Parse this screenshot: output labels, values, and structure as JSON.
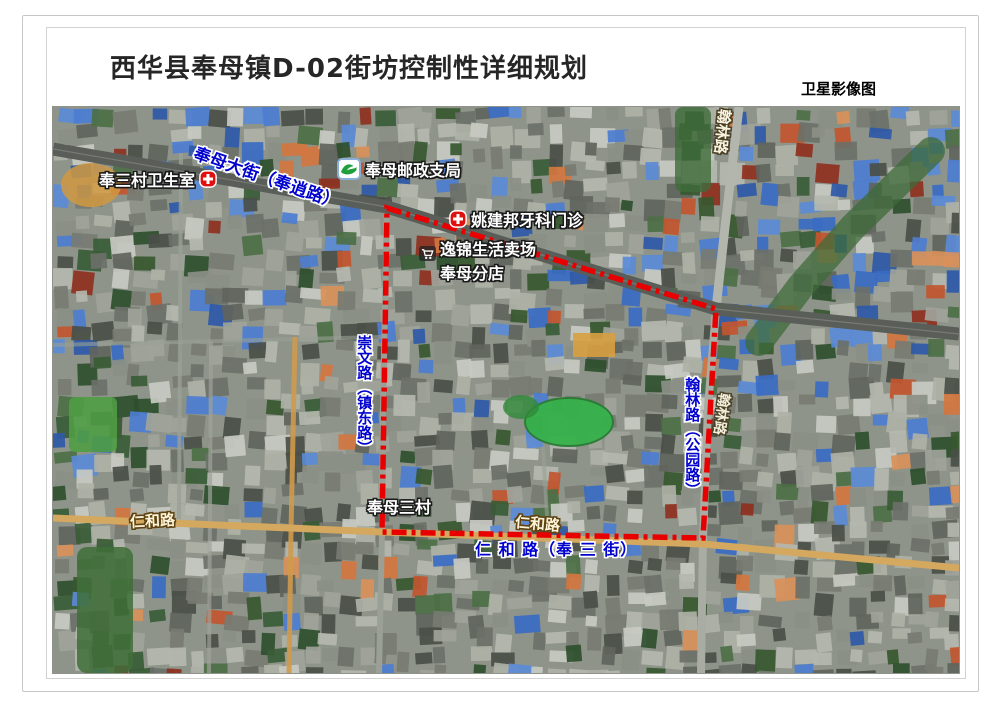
{
  "header": {
    "title": "西华县奉母镇D-02街坊控制性详细规划",
    "map_type_label": "卫星影像图"
  },
  "map": {
    "boundary": {
      "color": "#e80000",
      "style": "dash-dot"
    },
    "colors": {
      "blue_road_label": "#0202cf",
      "renhe_dirt_road": "#d4a85e",
      "main_street_asphalt": "#5a5e58",
      "pond_green": "#35b24a"
    },
    "road_labels": {
      "fengmu_street": "奉母大街（奉逍路）",
      "hanlin_road_top": "翰林路",
      "hanlin_road_mid": "翰林路",
      "chongwen_road": "崇文路（镇东路）",
      "hanlin_park_road": "翰林路（公园路）",
      "renhe_road_left": "仁和路",
      "renhe_road_mid": "仁和路",
      "renhe_road_blue": "仁 和 路（奉 三 街）"
    },
    "poi_labels": {
      "clinic": "奉三村卫生室",
      "post_office": "奉母邮政支局",
      "dental_clinic": "姚建邦牙科门诊",
      "market_line1": "逸锦生活卖场",
      "market_line2": "奉母分店",
      "village": "奉母三村"
    }
  }
}
